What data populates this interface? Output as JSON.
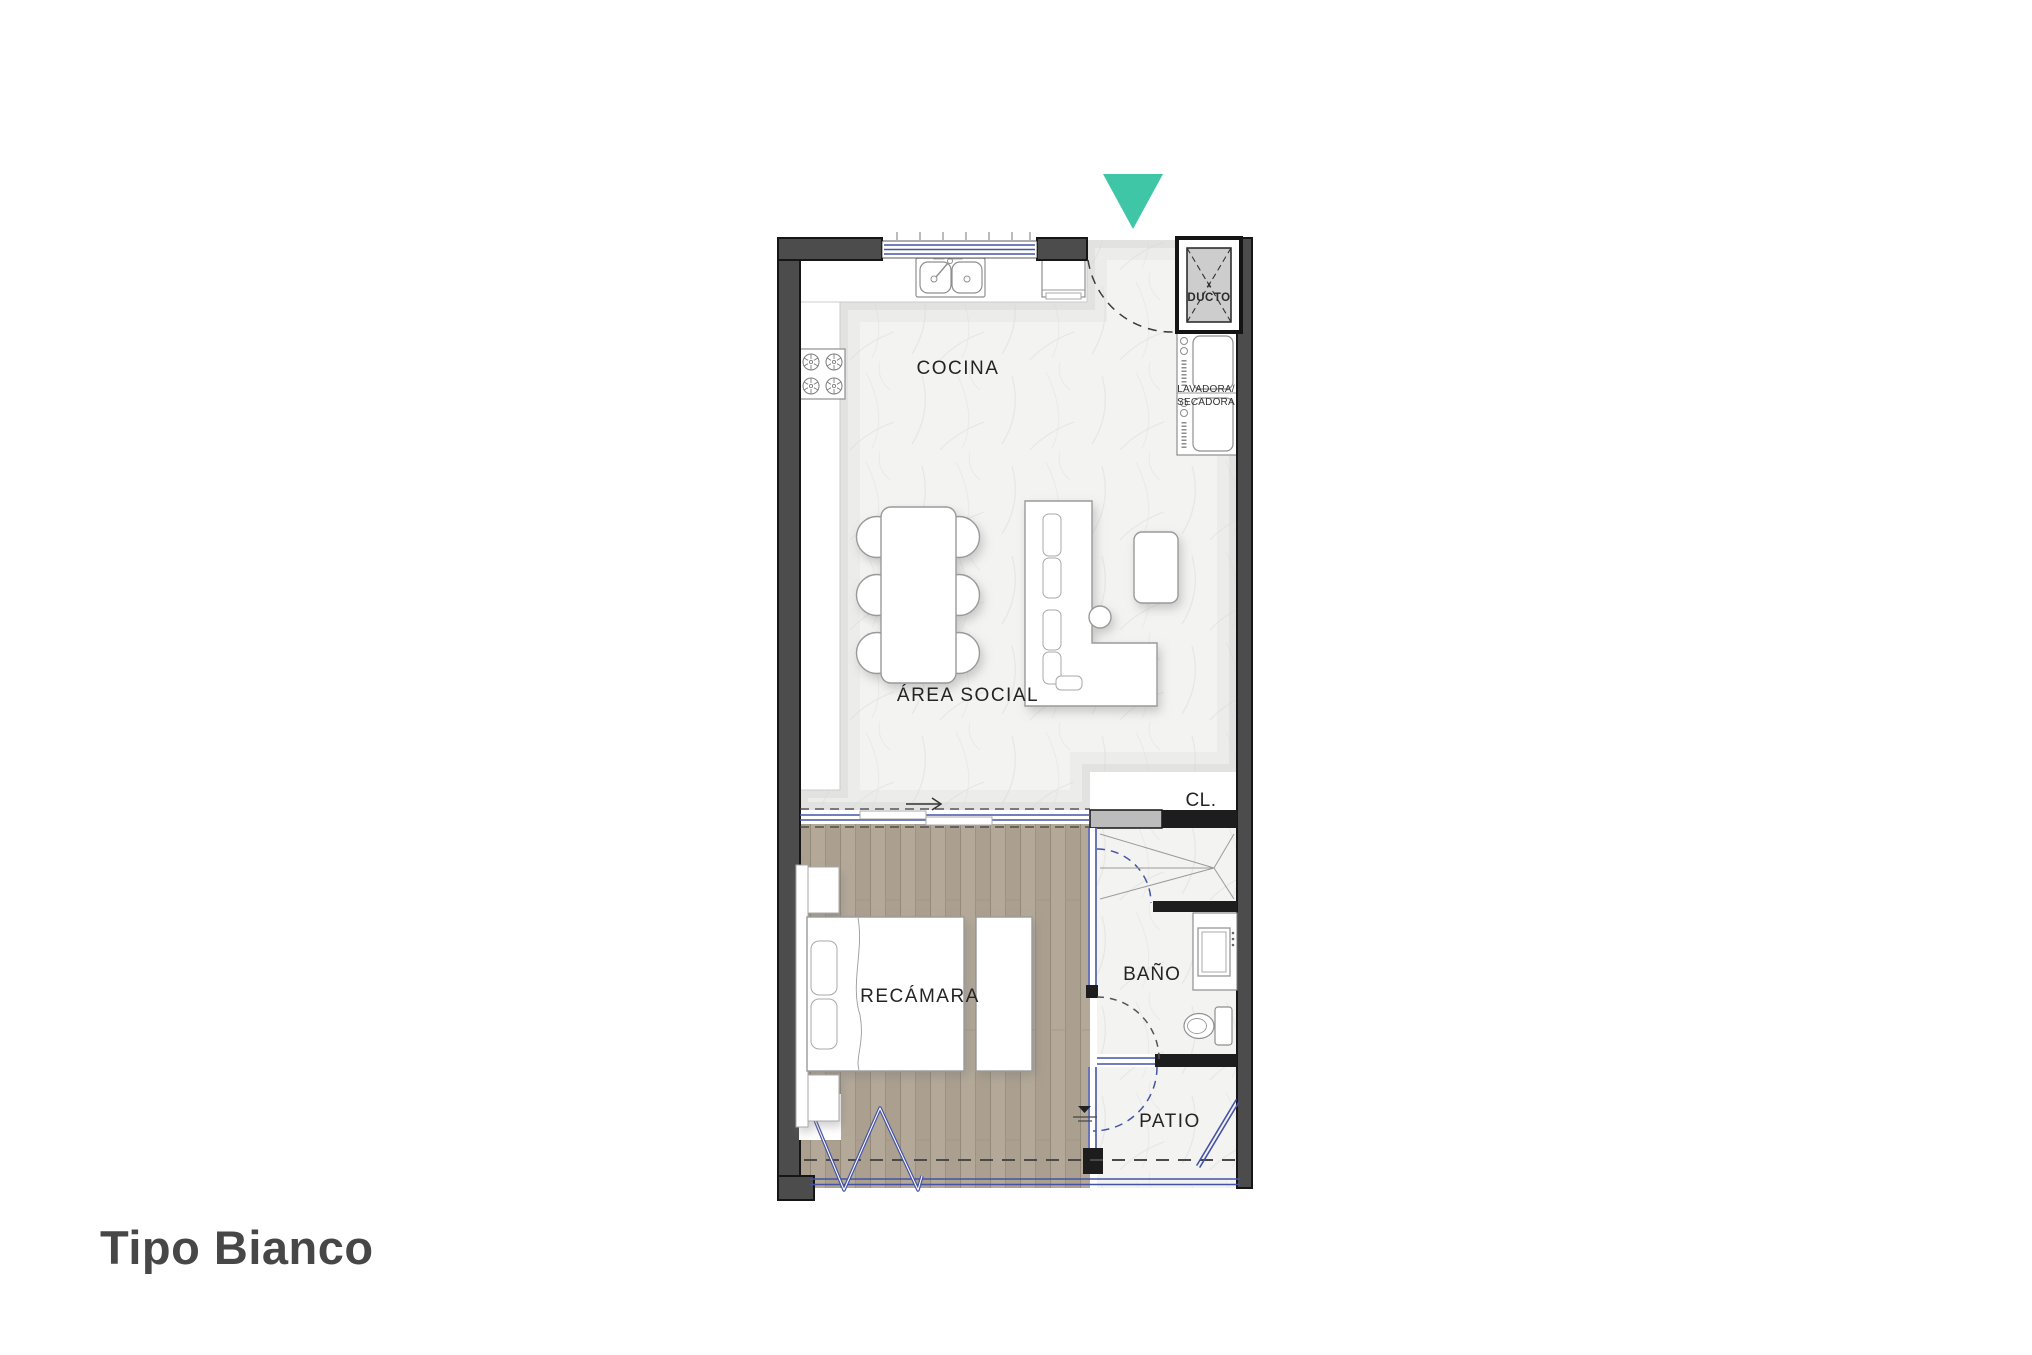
{
  "title": "Tipo Bianco",
  "colors": {
    "accent": "#3EC6A6",
    "glass": "#4553A6",
    "wall": "#4C4C4C",
    "wall_dark": "#1D1D1D",
    "wood": "#B3A898",
    "marble": "#F3F3F1"
  },
  "floor_plan": {
    "labels": {
      "kitchen": "COCINA",
      "social": "ÁREA SOCIAL",
      "bedroom": "RECÁMARA",
      "bathroom": "BAÑO",
      "patio": "PATIO",
      "closet": "CL.",
      "duct_mark": "x",
      "duct": "DUCTO",
      "washer1": "LAVADORA/",
      "washer2": "SECADORA"
    }
  }
}
